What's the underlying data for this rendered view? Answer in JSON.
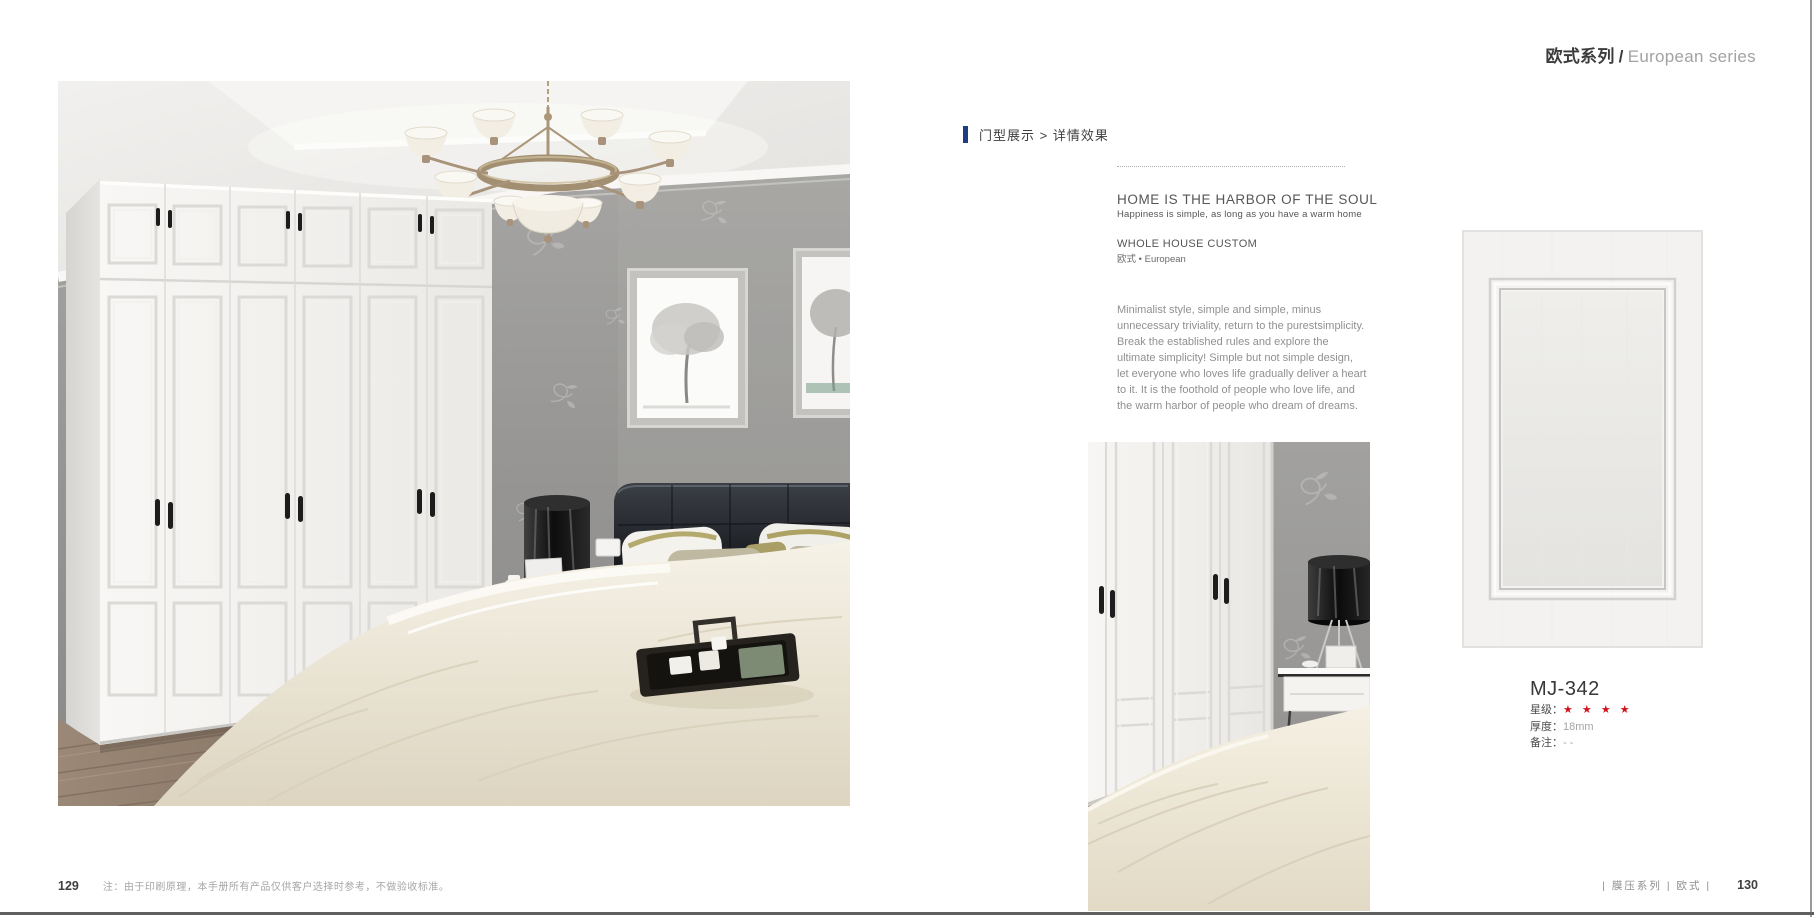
{
  "header": {
    "zh": "欧式系列",
    "slash": "/",
    "en": "European series"
  },
  "section": {
    "title": "门型展示 > 详情效果",
    "marker_color": "#1e3c87"
  },
  "intro": {
    "headline": "HOME IS THE HARBOR OF THE SOUL",
    "subheadline": "Happiness is simple, as long as you have a warm home",
    "custom_title": "WHOLE HOUSE CUSTOM",
    "custom_subtitle": "欧式 • European",
    "paragraph_lines": [
      "Minimalist style, simple and simple, minus",
      "unnecessary triviality, return to the purestsimplicity.",
      "Break the established rules and explore the",
      "ultimate simplicity! Simple but not simple design,",
      "let everyone who loves life gradually deliver a heart",
      "to it. It is the foothold of people who love life, and",
      "the warm harbor of people who dream of dreams."
    ]
  },
  "product": {
    "model": "MJ-342",
    "star_label": "星级：",
    "stars": "★ ★ ★ ★",
    "star_color": "#d0121b",
    "thickness_label": "厚度：",
    "thickness_value": "18mm",
    "note_label": "备注：",
    "note_value": "- -"
  },
  "footer": {
    "left_page_number": "129",
    "left_note": "注：由于印刷原理，本手册所有产品仅供客户选择时参考，不做验收标准。",
    "right_series": "| 膜压系列 | 欧式 |",
    "right_page_number": "130"
  }
}
